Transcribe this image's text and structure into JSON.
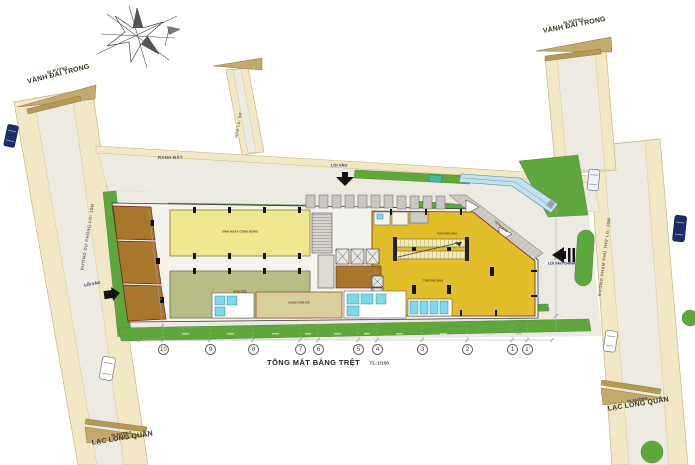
{
  "title": {
    "text": "TỔNG MẶT BẰNG TRỆT",
    "scale": "TL:1/150"
  },
  "roads": {
    "top_left": {
      "line1": "ĐI ĐƯỜNG",
      "line2": "VÀNH ĐAI TRONG"
    },
    "top_right": {
      "line1": "ĐI ĐƯỜNG",
      "line2": "VÀNH ĐAI TRONG"
    },
    "bottom_left": {
      "line1": "ĐI ĐƯỜNG",
      "line2": "LẠC LONG QUÂN"
    },
    "bottom_right": {
      "line1": "ĐI ĐƯỜNG",
      "line2": "LẠC LONG QUÂN"
    },
    "west_name": "ĐƯỜNG DỰ PHÓNG LG: 10M",
    "east_name": "ĐƯỜNG PHẠM PHÚ THỨ LG: 10M",
    "alley_name": "HẺM LG: 5M"
  },
  "site": {
    "boundary_label": "RANH ĐẤT",
    "entrance_top": "LỐI VÀO",
    "entrance_side": "LỐI VÀO",
    "entrance_main": "LỐI VÀO CHÍNH"
  },
  "rooms": {
    "community": "SINH HOẠT CỘNG ĐỒNG",
    "nursery": "NHÀ TRẺ",
    "retail_upper": "THƯƠNG MẠI",
    "retail_lower": "THƯƠNG MẠI",
    "lobby": "SẢNH CĂN HỘ",
    "corner_hall": "SẢNH ĐÓN"
  },
  "grid": {
    "bubbles": [
      "10",
      "9",
      "8",
      "7",
      "6",
      "5",
      "4",
      "3",
      "2",
      "1",
      "1'"
    ]
  },
  "colors": {
    "grass": "#5ea73d",
    "road_edge": "#f2e8c6",
    "road_surface": "#edeae2",
    "retail_gold": "#e3be2b",
    "room_yellow": "#efe88f",
    "room_olive": "#b8bc85",
    "room_brown": "#a9762e",
    "ramp_blue": "#c3e2ef",
    "service_cyan": "#7ed9e8",
    "car_navy": "#1c2e6a"
  }
}
